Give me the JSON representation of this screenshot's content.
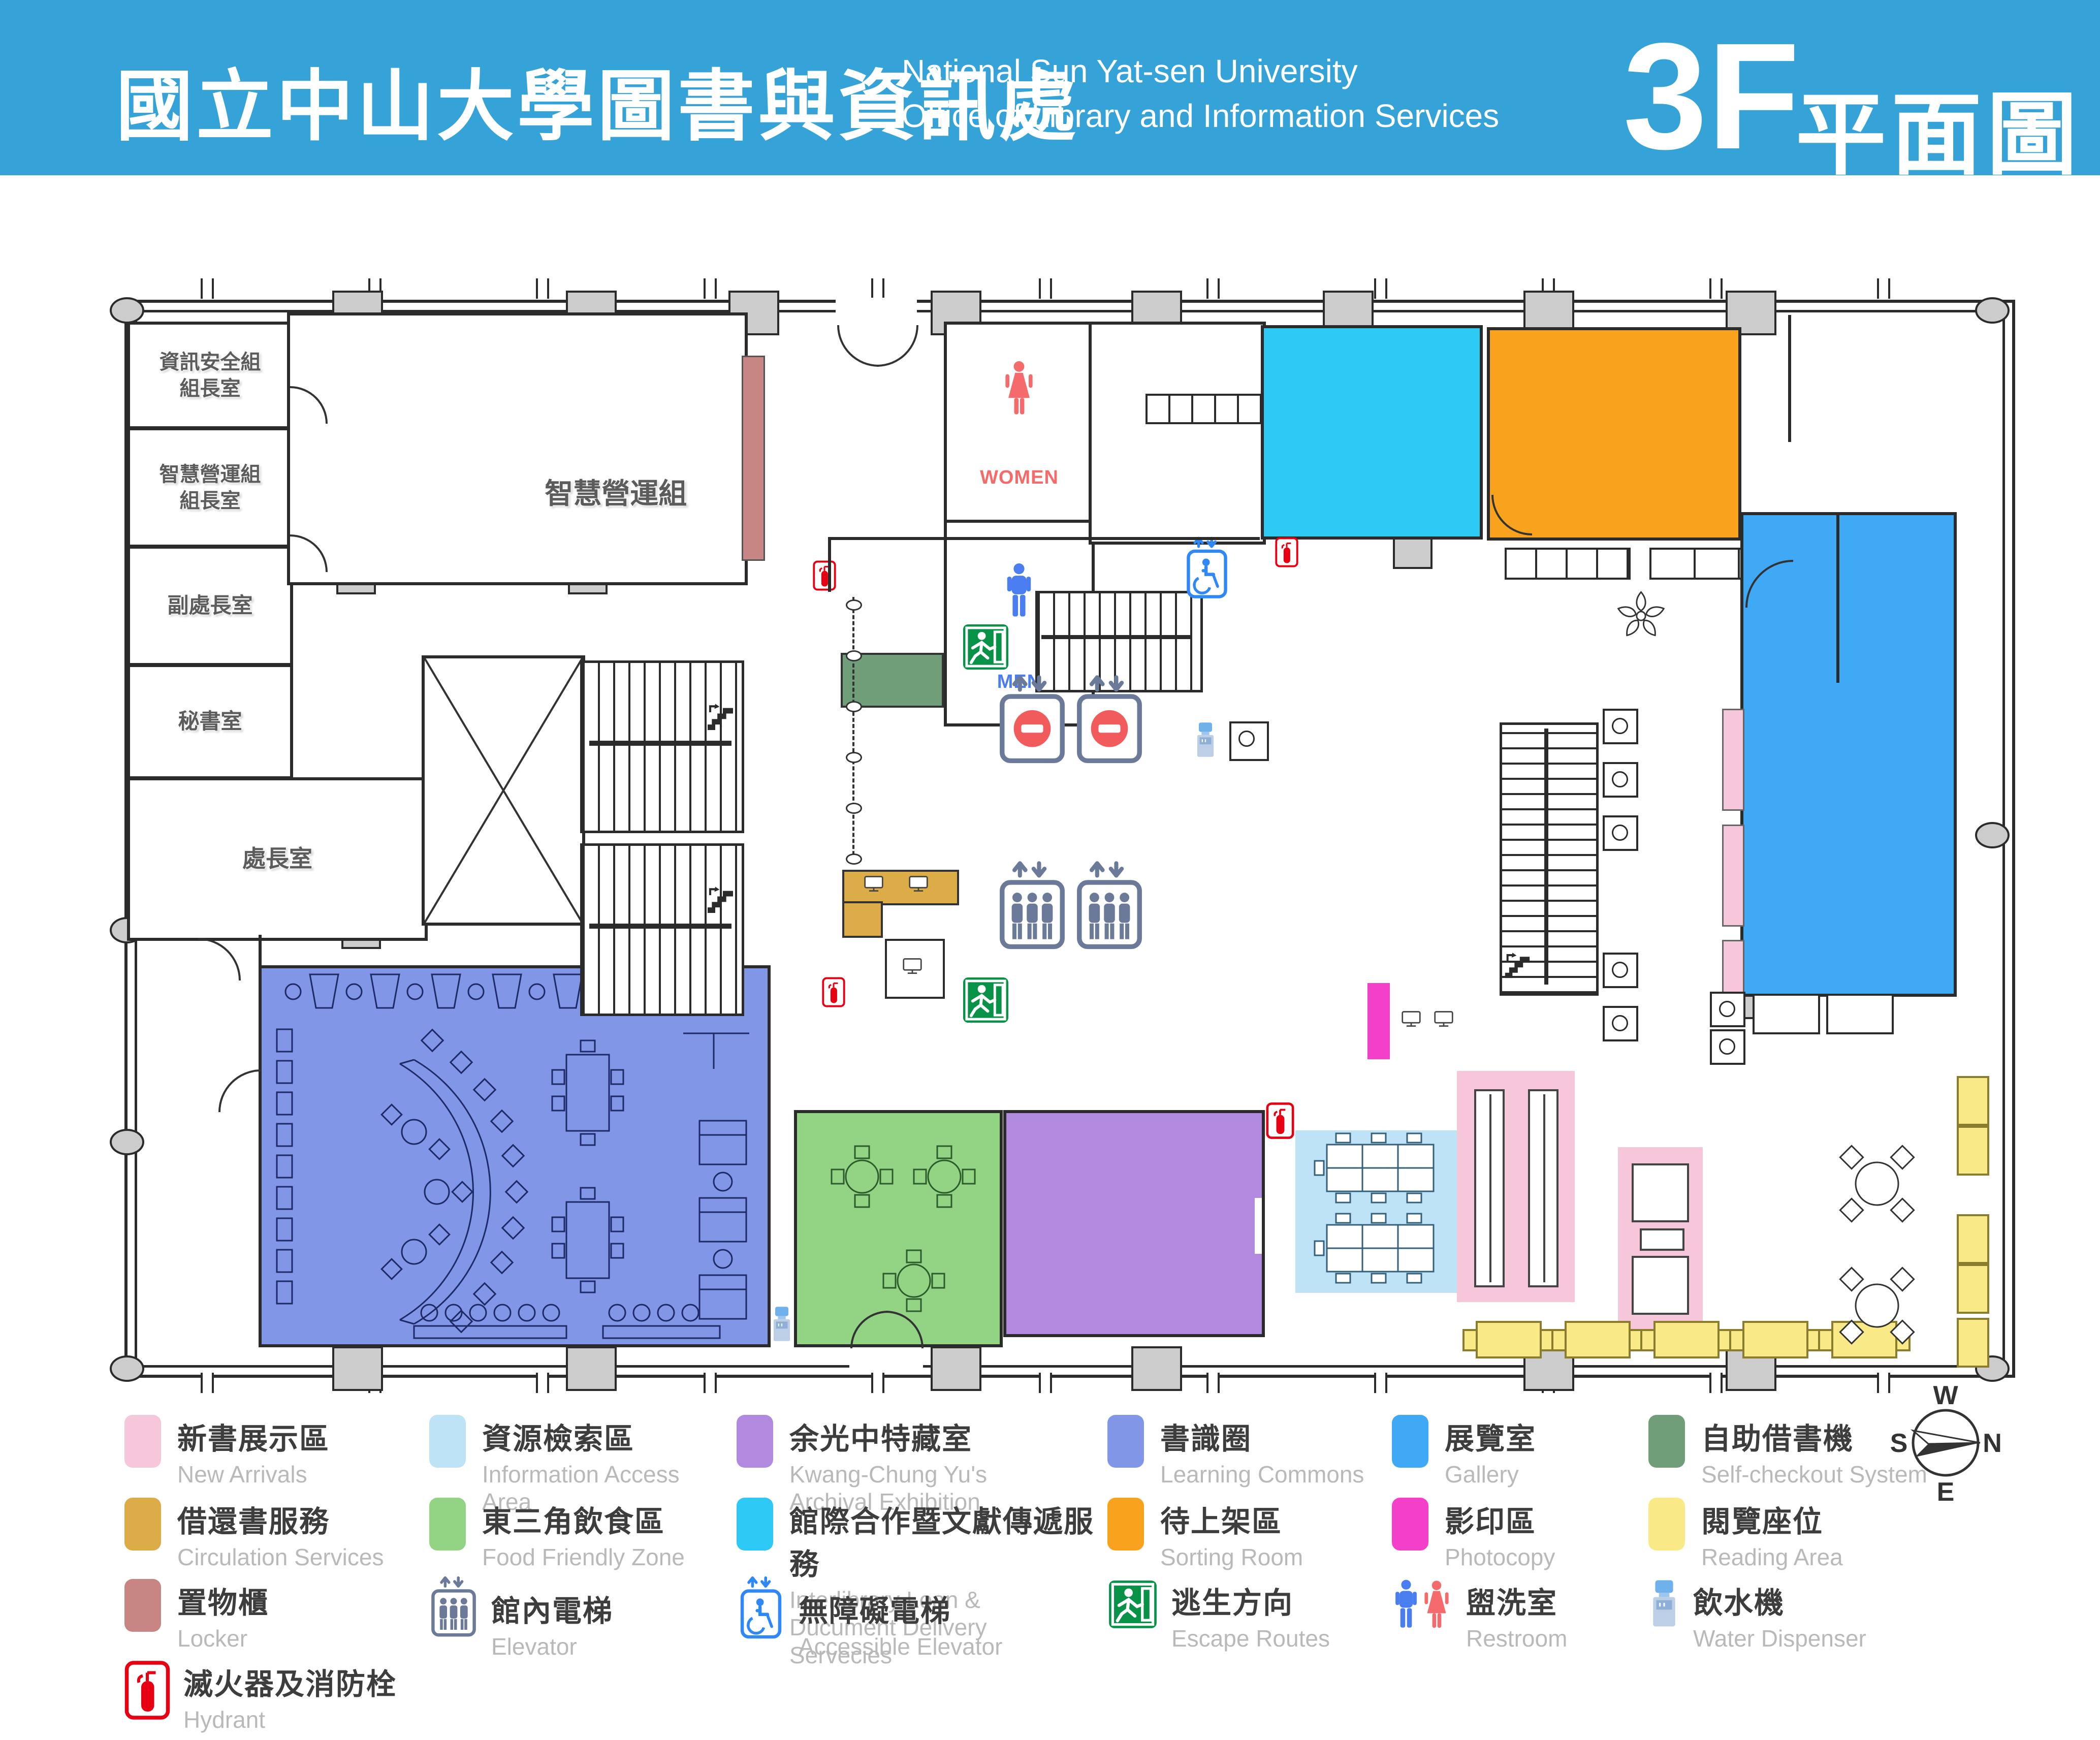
{
  "header": {
    "title_zh": "國立中山大學圖書與資訊處",
    "title_en_line1": "National Sun Yat-sen University",
    "title_en_line2": "Office of Library and Information Services",
    "floor": "3F",
    "floor_suffix_zh": "平面圖"
  },
  "plan": {
    "rooms": {
      "info_security_chief": "資訊安全組\n組長室",
      "smart_ops_chief": "智慧營運組\n組長室",
      "deputy_director": "副處長室",
      "secretary": "秘書室",
      "director": "處長室",
      "smart_operations": "智慧營運組"
    },
    "restroom_labels": {
      "women": "WOMEN",
      "men": "MEN"
    }
  },
  "legend": {
    "items": [
      {
        "id": "new-arrivals",
        "zh": "新書展示區",
        "en": "New Arrivals",
        "swatch": "#F6C6DB"
      },
      {
        "id": "information-access-area",
        "zh": "資源檢索區",
        "en": "Information Access Area",
        "swatch": "#BEE3F6"
      },
      {
        "id": "kwang-chung-yu-archival-exhibition",
        "zh": "余光中特藏室",
        "en": "Kwang-Chung Yu's Archival Exhibition",
        "swatch": "#B18AE0"
      },
      {
        "id": "learning-commons",
        "zh": "書識圈",
        "en": "Learning Commons",
        "swatch": "#8296E8"
      },
      {
        "id": "gallery",
        "zh": "展覽室",
        "en": "Gallery",
        "swatch": "#3FA9F5"
      },
      {
        "id": "self-checkout-system",
        "zh": "自助借書機",
        "en": "Self-checkout System",
        "swatch": "#6F9E79"
      },
      {
        "id": "circulation-services",
        "zh": "借還書服務",
        "en": "Circulation Services",
        "swatch": "#DCAC49"
      },
      {
        "id": "food-friendly-zone",
        "zh": "東三角飲食區",
        "en": "Food Friendly Zone",
        "swatch": "#92D384"
      },
      {
        "id": "interlibrary-loan",
        "zh": "館際合作暨文獻傳遞服務",
        "en": "Interlibrary Loan & Ducument Delivery Servecies",
        "swatch": "#2EC8F4"
      },
      {
        "id": "sorting-room",
        "zh": "待上架區",
        "en": "Sorting Room",
        "swatch": "#F9A21D"
      },
      {
        "id": "photocopy",
        "zh": "影印區",
        "en": "Photocopy",
        "swatch": "#F33FC9"
      },
      {
        "id": "reading-area",
        "zh": "閱覽座位",
        "en": "Reading Area",
        "swatch": "#F9EA87"
      },
      {
        "id": "locker",
        "zh": "置物櫃",
        "en": "Locker",
        "swatch": "#C78584"
      },
      {
        "id": "elevator",
        "zh": "館內電梯",
        "en": "Elevator",
        "icon": "elevator-icon"
      },
      {
        "id": "accessible-elevator",
        "zh": "無障礙電梯",
        "en": "Accessible Elevator",
        "icon": "accessible-elevator-icon"
      },
      {
        "id": "escape-routes",
        "zh": "逃生方向",
        "en": "Escape Routes",
        "icon": "escape-exit-icon"
      },
      {
        "id": "restroom",
        "zh": "盥洗室",
        "en": "Restroom",
        "icon": "restroom-icon"
      },
      {
        "id": "water-dispenser",
        "zh": "飲水機",
        "en": "Water Dispenser",
        "icon": "water-dispenser-icon"
      },
      {
        "id": "hydrant",
        "zh": "滅火器及消防栓",
        "en": "Hydrant",
        "icon": "fire-extinguisher-icon"
      }
    ]
  },
  "compass": {
    "w": "W",
    "n": "N",
    "e": "E",
    "s": "S"
  },
  "colors": {
    "header": "#36A3D8",
    "wall": "#2b2b2b",
    "learning_commons": "#8296E8",
    "gallery": "#3FA9F5",
    "interlibrary": "#2EC8F4",
    "sorting": "#F9A21D",
    "food": "#92D384",
    "exhibition": "#B18AE0",
    "info_access": "#BEE3F6",
    "new_arrivals": "#F6C6DB",
    "reading": "#F9EA87",
    "photocopy": "#F33FC9",
    "locker": "#C78584",
    "circulation": "#DCAC49",
    "self_checkout": "#6F9E79",
    "exit_green": "#089247",
    "hydrant_red": "#E60012",
    "men_blue": "#4A7DF0",
    "women_red": "#F56A6A",
    "elevator_slate": "#6B7A99",
    "accessible_blue": "#2F88F7"
  },
  "icons": {
    "elevator": "elevator-icon",
    "accessible_elevator": "accessible-elevator-icon",
    "escape_routes": "escape-exit-icon",
    "restroom_men": "man-icon",
    "restroom_women": "woman-icon",
    "water_dispenser": "water-dispenser-icon",
    "hydrant": "fire-extinguisher-icon",
    "stairs": "stairs-icon",
    "monitor": "monitor-icon",
    "flower_seat": "flower-seating-icon",
    "compass": "compass-rose"
  }
}
